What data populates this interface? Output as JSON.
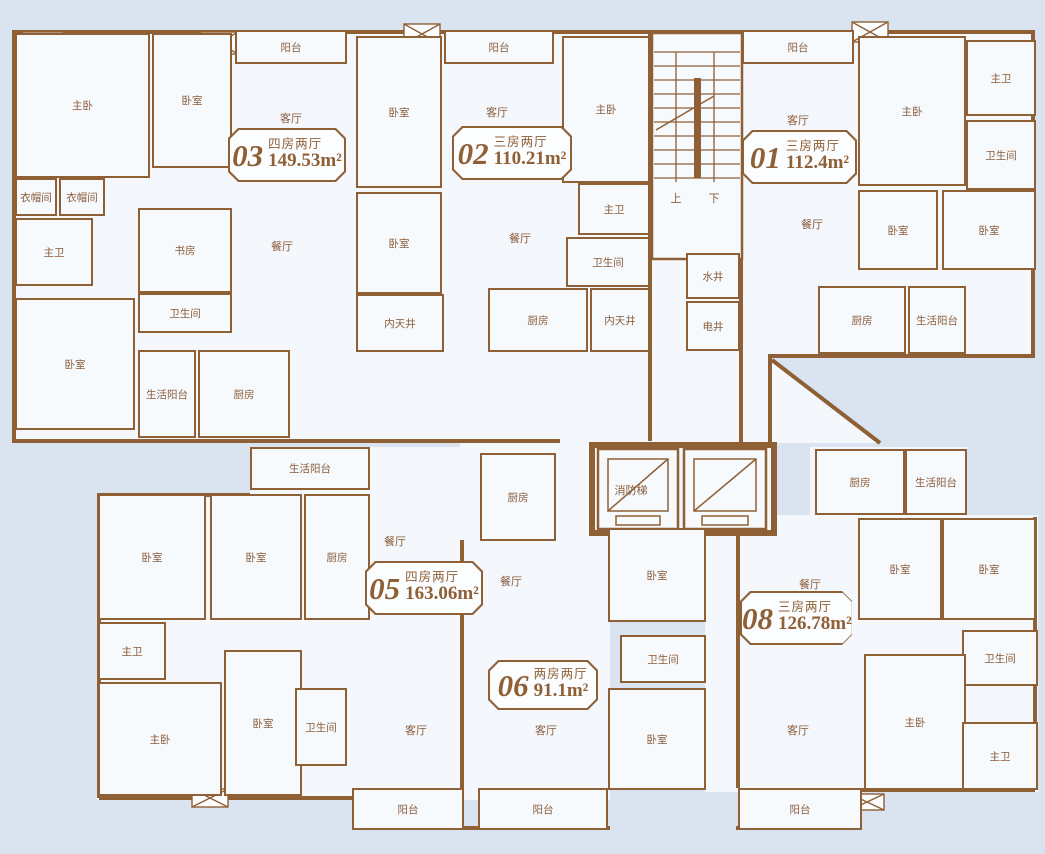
{
  "colors": {
    "background": "#d9e4f0",
    "wall": "#8f5f35",
    "floor": "#f4f8fc",
    "label_text": "#8a5c3b"
  },
  "units": [
    {
      "number": "03",
      "layout": "四房两厅",
      "area": "149.53m²",
      "badge": {
        "x": 228,
        "y": 128,
        "w": 118,
        "h": 54
      },
      "rooms": [
        {
          "label": "主卧",
          "x": 15,
          "y": 33,
          "w": 135,
          "h": 145
        },
        {
          "label": "卧室",
          "x": 152,
          "y": 33,
          "w": 80,
          "h": 135
        },
        {
          "label": "阳台",
          "x": 235,
          "y": 30,
          "w": 112,
          "h": 34
        },
        {
          "label": "衣帽间",
          "x": 15,
          "y": 178,
          "w": 42,
          "h": 38
        },
        {
          "label": "衣帽间",
          "x": 59,
          "y": 178,
          "w": 46,
          "h": 38
        },
        {
          "label": "主卫",
          "x": 15,
          "y": 218,
          "w": 78,
          "h": 68
        },
        {
          "label": "书房",
          "x": 138,
          "y": 208,
          "w": 94,
          "h": 85
        },
        {
          "label": "卫生间",
          "x": 138,
          "y": 293,
          "w": 94,
          "h": 40
        },
        {
          "label": "卧室",
          "x": 15,
          "y": 298,
          "w": 120,
          "h": 132
        },
        {
          "label": "生活阳台",
          "x": 138,
          "y": 350,
          "w": 58,
          "h": 88
        },
        {
          "label": "厨房",
          "x": 198,
          "y": 350,
          "w": 92,
          "h": 88
        }
      ],
      "open_labels": [
        {
          "label": "客厅",
          "x": 291,
          "y": 118
        },
        {
          "label": "餐厅",
          "x": 282,
          "y": 246
        }
      ]
    },
    {
      "number": "02",
      "layout": "三房两厅",
      "area": "110.21m²",
      "badge": {
        "x": 452,
        "y": 126,
        "w": 120,
        "h": 54
      },
      "rooms": [
        {
          "label": "卧室",
          "x": 356,
          "y": 36,
          "w": 86,
          "h": 152
        },
        {
          "label": "阳台",
          "x": 444,
          "y": 30,
          "w": 110,
          "h": 34
        },
        {
          "label": "主卧",
          "x": 562,
          "y": 36,
          "w": 88,
          "h": 147
        },
        {
          "label": "主卫",
          "x": 578,
          "y": 183,
          "w": 72,
          "h": 52
        },
        {
          "label": "卧室",
          "x": 356,
          "y": 192,
          "w": 86,
          "h": 102
        },
        {
          "label": "卫生间",
          "x": 566,
          "y": 237,
          "w": 84,
          "h": 50
        },
        {
          "label": "内天井",
          "x": 356,
          "y": 294,
          "w": 88,
          "h": 58
        },
        {
          "label": "厨房",
          "x": 488,
          "y": 288,
          "w": 100,
          "h": 64
        },
        {
          "label": "内天井",
          "x": 590,
          "y": 288,
          "w": 60,
          "h": 64
        }
      ],
      "open_labels": [
        {
          "label": "客厅",
          "x": 497,
          "y": 112
        },
        {
          "label": "餐厅",
          "x": 520,
          "y": 238
        }
      ]
    },
    {
      "number": "01",
      "layout": "三房两厅",
      "area": "112.4m²",
      "badge": {
        "x": 742,
        "y": 130,
        "w": 115,
        "h": 54
      },
      "rooms": [
        {
          "label": "阳台",
          "x": 742,
          "y": 30,
          "w": 112,
          "h": 34
        },
        {
          "label": "主卧",
          "x": 858,
          "y": 36,
          "w": 108,
          "h": 150
        },
        {
          "label": "主卫",
          "x": 966,
          "y": 40,
          "w": 70,
          "h": 76
        },
        {
          "label": "卫生间",
          "x": 966,
          "y": 120,
          "w": 70,
          "h": 70
        },
        {
          "label": "卧室",
          "x": 858,
          "y": 190,
          "w": 80,
          "h": 80
        },
        {
          "label": "卧室",
          "x": 942,
          "y": 190,
          "w": 94,
          "h": 80
        },
        {
          "label": "厨房",
          "x": 818,
          "y": 286,
          "w": 88,
          "h": 68
        },
        {
          "label": "生活阳台",
          "x": 908,
          "y": 286,
          "w": 58,
          "h": 68
        }
      ],
      "open_labels": [
        {
          "label": "客厅",
          "x": 798,
          "y": 120
        },
        {
          "label": "餐厅",
          "x": 812,
          "y": 224
        }
      ]
    },
    {
      "number": "05",
      "layout": "四房两厅",
      "area": "163.06m²",
      "badge": {
        "x": 365,
        "y": 561,
        "w": 118,
        "h": 54
      },
      "rooms": [
        {
          "label": "生活阳台",
          "x": 250,
          "y": 447,
          "w": 120,
          "h": 43
        },
        {
          "label": "卧室",
          "x": 98,
          "y": 494,
          "w": 108,
          "h": 126
        },
        {
          "label": "卧室",
          "x": 210,
          "y": 494,
          "w": 92,
          "h": 126
        },
        {
          "label": "厨房",
          "x": 304,
          "y": 494,
          "w": 66,
          "h": 126
        },
        {
          "label": "主卫",
          "x": 98,
          "y": 622,
          "w": 68,
          "h": 58
        },
        {
          "label": "主卧",
          "x": 98,
          "y": 682,
          "w": 124,
          "h": 114
        },
        {
          "label": "卧室",
          "x": 224,
          "y": 650,
          "w": 78,
          "h": 146
        },
        {
          "label": "卫生间",
          "x": 295,
          "y": 688,
          "w": 52,
          "h": 78
        },
        {
          "label": "阳台",
          "x": 352,
          "y": 788,
          "w": 112,
          "h": 42
        }
      ],
      "open_labels": [
        {
          "label": "餐厅",
          "x": 395,
          "y": 541
        },
        {
          "label": "客厅",
          "x": 416,
          "y": 730
        }
      ]
    },
    {
      "number": "06",
      "layout": "两房两厅",
      "area": "91.1m²",
      "badge": {
        "x": 488,
        "y": 660,
        "w": 110,
        "h": 50
      },
      "rooms": [
        {
          "label": "厨房",
          "x": 480,
          "y": 453,
          "w": 76,
          "h": 88
        },
        {
          "label": "卧室",
          "x": 608,
          "y": 528,
          "w": 98,
          "h": 94
        },
        {
          "label": "卫生间",
          "x": 620,
          "y": 635,
          "w": 86,
          "h": 48
        },
        {
          "label": "卧室",
          "x": 608,
          "y": 688,
          "w": 98,
          "h": 102
        },
        {
          "label": "阳台",
          "x": 478,
          "y": 788,
          "w": 130,
          "h": 42
        }
      ],
      "open_labels": [
        {
          "label": "餐厅",
          "x": 511,
          "y": 581
        },
        {
          "label": "客厅",
          "x": 546,
          "y": 730
        }
      ]
    },
    {
      "number": "08",
      "layout": "三房两厅",
      "area": "126.78m²",
      "badge": {
        "x": 740,
        "y": 591,
        "w": 112,
        "h": 54
      },
      "rooms": [
        {
          "label": "厨房",
          "x": 815,
          "y": 449,
          "w": 90,
          "h": 66
        },
        {
          "label": "生活阳台",
          "x": 905,
          "y": 449,
          "w": 62,
          "h": 66
        },
        {
          "label": "卧室",
          "x": 858,
          "y": 518,
          "w": 84,
          "h": 102
        },
        {
          "label": "卧室",
          "x": 942,
          "y": 518,
          "w": 94,
          "h": 102
        },
        {
          "label": "卫生间",
          "x": 962,
          "y": 630,
          "w": 76,
          "h": 56
        },
        {
          "label": "主卧",
          "x": 864,
          "y": 654,
          "w": 102,
          "h": 136
        },
        {
          "label": "主卫",
          "x": 962,
          "y": 722,
          "w": 76,
          "h": 68
        },
        {
          "label": "阳台",
          "x": 738,
          "y": 788,
          "w": 124,
          "h": 42
        }
      ],
      "open_labels": [
        {
          "label": "餐厅",
          "x": 810,
          "y": 584
        },
        {
          "label": "客厅",
          "x": 798,
          "y": 730
        }
      ]
    }
  ],
  "core": {
    "rooms": [
      {
        "label": "水井",
        "x": 686,
        "y": 253,
        "w": 54,
        "h": 46
      },
      {
        "label": "电井",
        "x": 686,
        "y": 301,
        "w": 54,
        "h": 50
      }
    ],
    "labels": [
      {
        "label": "上",
        "x": 676,
        "y": 198
      },
      {
        "label": "下",
        "x": 714,
        "y": 198
      },
      {
        "label": "消防梯",
        "x": 631,
        "y": 490
      }
    ]
  }
}
